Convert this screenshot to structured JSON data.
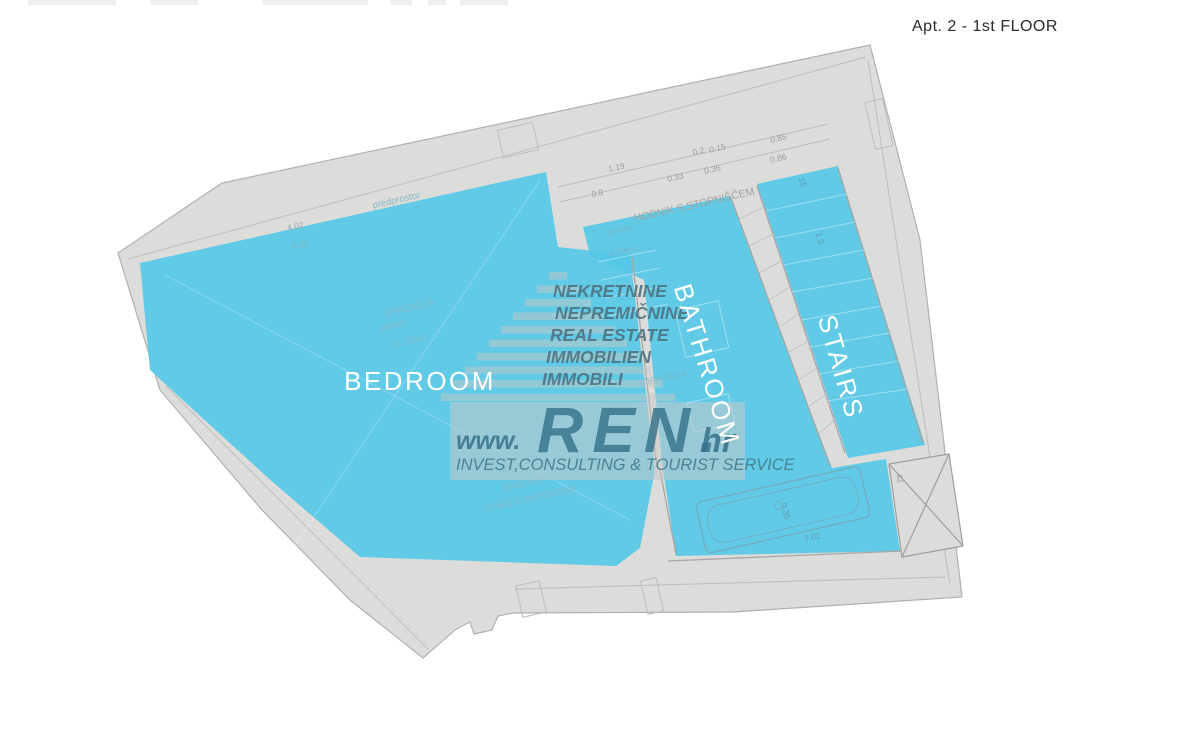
{
  "title": "Apt. 2 - 1st FLOOR",
  "room_labels": {
    "bedroom": "BEDROOM",
    "bathroom": "BATHROOM",
    "stairs": "STAIRS"
  },
  "plan_text": {
    "anteroom": "predprostor",
    "bedroom_name": "SPALNICA",
    "bedroom_floor": "parket",
    "bedroom_area": "11.23m2",
    "hall_name": "HODNIK S STOPNIŠČEM",
    "hall_floor": "parket",
    "hall_area": "4.20m2",
    "bath_name": "KOPALNICA",
    "glass_line1": "KALJENO",
    "glass_line2": "PROZORNO STEKLO"
  },
  "dims": {
    "d1": "4.02",
    "d2": "4.08",
    "d3": "1.19",
    "d4": "0.8",
    "d5": "0.33",
    "d6": "0.36",
    "d7": "0.2",
    "d8": "0.15",
    "d9": "0.85",
    "d10": "0.86",
    "d11": "15",
    "d12": "1.3",
    "d13": "7.02",
    "d14": "0.35",
    "d15": "42"
  },
  "watermark": {
    "lang1": "NEKRETNINE",
    "lang2": "NEPREMIČNINE",
    "lang3": "REAL ESTATE",
    "lang4": "IMMOBILIEN",
    "lang5": "IMMOBILI",
    "www": "www.",
    "name": "REN.",
    "tld": "hr",
    "tagline": "INVEST,CONSULTING & TOURIST SERVICE"
  },
  "colors": {
    "highlight": "#55c8e8",
    "paper": "#dcdcda",
    "watermark_teal": "#35718a",
    "title_text": "#2b2b2b"
  }
}
